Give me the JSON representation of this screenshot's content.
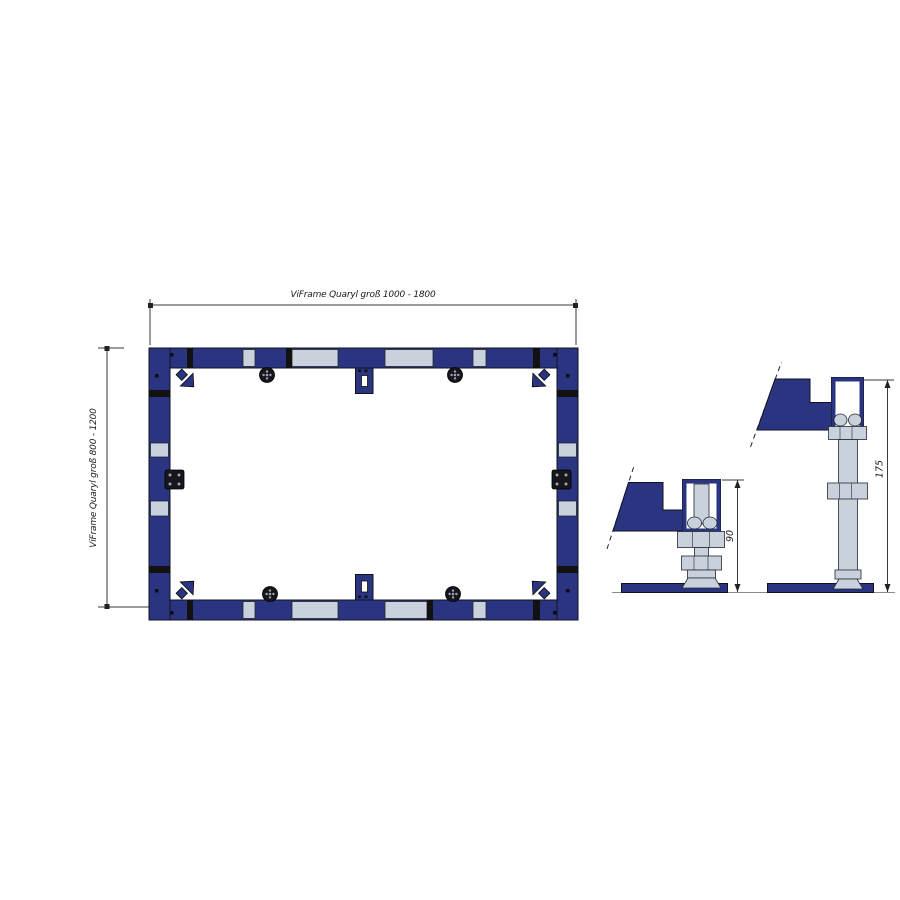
{
  "drawing": {
    "title": "ViFrame Quaryl frame installation drawing",
    "labels": {
      "top_dimension": "ViFrame Quaryl groß 1000 - 1800",
      "left_dimension": "ViFrame Quaryl groß 800 - 1200",
      "short_foot_height": "90",
      "tall_foot_height": "175"
    }
  },
  "colors": {
    "frame_navy": "#2a3480",
    "segment_gray": "#c9d2dc",
    "joint_black": "#111111",
    "metal_dark": "#16161c",
    "dimension_line": "#3a3a3a",
    "background": "#ffffff"
  },
  "icons": {
    "corner-arrow-icon": "navy chevron arrow pointing diagonally inward at each frame corner",
    "adjuster-knob-icon": "round knurled adjustable-foot knob seen from above",
    "bracket-tab-icon": "slotted mounting tab on frame centerline",
    "mount-plate-icon": "square fixing plate with four screw dots",
    "foot-bracket-icon": "navy stepped support bracket with hatched cut edge"
  }
}
